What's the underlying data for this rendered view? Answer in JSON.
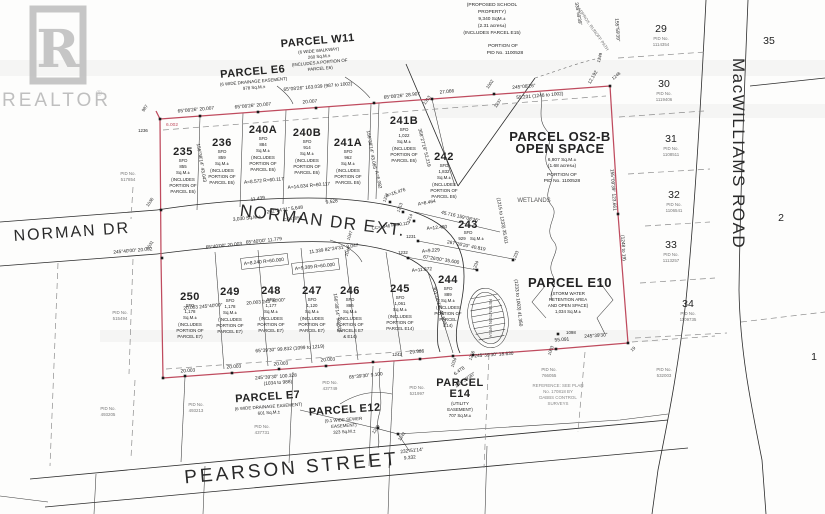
{
  "watermark": {
    "letter": "R",
    "brand": "REALTOR",
    "reg": "®"
  },
  "streets": {
    "norman_dr": "NORMAN DR",
    "norman_dr_ext": "NORMAN DR EXT.",
    "pearson": "PEARSON STREET",
    "macwilliams": "MacWILLIAMS ROAD",
    "nde_area": "3,030 Sq.M.±"
  },
  "school": {
    "l1": "(PROPOSED SCHOOL",
    "l2": "PROPERTY)",
    "l3": "9,340 SqM.±",
    "l4": "(2.31 acres±)",
    "l5": "(INCLUDES PARCEL E15)",
    "l6": "PORTION OF",
    "l7": "PID No. 1100528"
  },
  "parcels": {
    "e6": {
      "name": "PARCEL E6",
      "d1": "(6 WIDE DRAINAGE EASEMENT)",
      "d2": "978 Sq.M.±"
    },
    "w11": {
      "name": "PARCEL W11",
      "d1": "(6 WIDE WALKWAY)",
      "d2": "260 Sq.M.±",
      "d3": "(INCLUDES A PORTION OF",
      "d4": "PARCEL E6)"
    },
    "os2b": {
      "name": "PARCEL OS2-B",
      "name2": "OPEN SPACE",
      "d1": "6,807 Sq.M.±",
      "d2": "(1.68 acres±)",
      "d3": "PORTION OF",
      "d4": "PID No. 1100528"
    },
    "e10": {
      "name": "PARCEL E10",
      "d1": "(STORM WATER",
      "d2": "RETENTION AREA",
      "d3": "AND OPEN SPACE)",
      "d4": "1,034 Sq.M.±"
    },
    "e7": {
      "name": "PARCEL E7",
      "d1": "(6 WIDE DRAINAGE EASEMENT)",
      "d2": "601 Sq.M.±"
    },
    "e12": {
      "name": "PARCEL E12",
      "d1": "(9.1 WIDE SEWER",
      "d2": "EASEMENT)",
      "d3": "323 Sq.M.±"
    },
    "e14": {
      "name": "PARCEL",
      "name2": "E14",
      "d1": "(UTILITY",
      "d2": "EASEMENT)",
      "d3": "707 Sq.M.±"
    }
  },
  "lots": {
    "235": {
      "num": "235",
      "type": "SFD",
      "area": "855",
      "unit": "Sq.M.±",
      "n1": "(INCLUDES",
      "n2": "PORTION OF",
      "n3": "PARCEL E6)"
    },
    "236": {
      "num": "236",
      "type": "SFD",
      "area": "859",
      "unit": "Sq.M.±",
      "n1": "(INCLUDES",
      "n2": "PORTION OF",
      "n3": "PARCEL E6)"
    },
    "240A": {
      "num": "240A",
      "type": "SFD",
      "area": "884",
      "unit": "Sq.M.±",
      "n1": "(INCLUDES",
      "n2": "PORTION OF",
      "n3": "PARCEL E6)"
    },
    "240B": {
      "num": "240B",
      "type": "SFD",
      "area": "914",
      "unit": "Sq.M.±",
      "n1": "(INCLUDES",
      "n2": "PORTION OF",
      "n3": "PARCEL E6)"
    },
    "241A": {
      "num": "241A",
      "type": "SFD",
      "area": "962",
      "unit": "Sq.M.±",
      "n1": "(INCLUDES",
      "n2": "PORTION OF",
      "n3": "PARCEL E6)"
    },
    "241B": {
      "num": "241B",
      "type": "SFD",
      "area": "1,022",
      "unit": "Sq.M.±",
      "n1": "(INCLUDES",
      "n2": "PORTION OF",
      "n3": "PARCEL E6)"
    },
    "242": {
      "num": "242",
      "type": "SFD",
      "area": "1,832",
      "unit": "Sq.M.±",
      "n1": "(INCLUDES",
      "n2": "PORTION OF",
      "n3": "PARCEL E6)"
    },
    "243": {
      "num": "243",
      "type": "SFD",
      "area": "929",
      "unit": "Sq.M.±"
    },
    "244": {
      "num": "244",
      "type": "SFD",
      "area": "889",
      "unit": "Sq.M.±",
      "n1": "(INCLUDES",
      "n2": "PORTION OF",
      "n3": "PARCEL",
      "n4": "E14)"
    },
    "245": {
      "num": "245",
      "type": "SFD",
      "area": "1,061",
      "unit": "Sq.M.±",
      "n1": "(INCLUDES",
      "n2": "PORTION OF",
      "n3": "PARCEL E14)"
    },
    "246": {
      "num": "246",
      "type": "SFD",
      "area": "886",
      "unit": "Sq.M.±",
      "n1": "(INCLUDES",
      "n2": "PORTION OF",
      "n3": "PARCELS E7",
      "n4": "& E14)"
    },
    "247": {
      "num": "247",
      "type": "SFD",
      "area": "1,120",
      "unit": "Sq.M.±",
      "n1": "(INCLUDES",
      "n2": "PORTION OF",
      "n3": "PARCEL E7)"
    },
    "248": {
      "num": "248",
      "type": "SFD",
      "area": "1,177",
      "unit": "Sq.M.±",
      "n1": "(INCLUDES",
      "n2": "PORTION OF",
      "n3": "PARCEL E7)"
    },
    "249": {
      "num": "249",
      "type": "SFD",
      "area": "1,178",
      "unit": "Sq.M.±",
      "n1": "(INCLUDES",
      "n2": "PORTION OF",
      "n3": "PARCEL E7)"
    },
    "250": {
      "num": "250",
      "type": "SFD",
      "area": "1,178",
      "unit": "Sq.M.±",
      "n1": "(INCLUDES",
      "n2": "PORTION OF",
      "n3": "PARCEL E7)"
    }
  },
  "adj": {
    "29": {
      "num": "29",
      "pid": "PID No.",
      "pidno": "1114354"
    },
    "30": {
      "num": "30",
      "pid": "PID No.",
      "pidno": "1119406"
    },
    "31": {
      "num": "31",
      "pid": "PID No.",
      "pidno": "1108511"
    },
    "32": {
      "num": "32",
      "pid": "PID No.",
      "pidno": "1106541"
    },
    "33": {
      "num": "33",
      "pid": "PID No.",
      "pidno": "1113257"
    },
    "34": {
      "num": "34",
      "pid": "PID No.",
      "pidno": "1109735"
    },
    "35": {
      "num": "35"
    },
    "2": {
      "num": "2"
    },
    "1": {
      "num": "1"
    }
  },
  "pids": {
    "p517854": {
      "a": "PID No.",
      "b": "517854"
    },
    "p515494": {
      "a": "PID No.",
      "b": "515494"
    },
    "p493205": {
      "a": "PID No.",
      "b": "493205"
    },
    "p493213": {
      "a": "PID No.",
      "b": "493213"
    },
    "p437731": {
      "a": "PID No.",
      "b": "437731"
    },
    "p437749": {
      "a": "PID No.",
      "b": "437749"
    },
    "p521997": {
      "a": "PID No.",
      "b": "521997"
    },
    "p766055": {
      "a": "PID No.",
      "b": "766055"
    },
    "p532003": {
      "a": "PID No.",
      "b": "532003"
    }
  },
  "dims": [
    "65°08'26\"  20.007",
    "65°08'26\"  20.007",
    "65°08'26\"  163.039  (987 to 1002)",
    "20.007",
    "65°08'26\"  28.907",
    "27.066",
    "245°08'26\"",
    "55.231  (1248 to 1002)",
    "12.192",
    "6.002",
    "20.003  245°40'00\"",
    "20.003  245°40'00\"",
    "11.439",
    "262°24'31\"  5.648",
    "9.528",
    "65°40'00\"  20.003",
    "65°40'00\"  11.779",
    "A=8.240  R=60.000",
    "A=9.389  R=60.000",
    "11.339  82°24'31\"  8.047",
    "A=15.476",
    "A=6.082",
    "A=8.464",
    "45.716  159°08'26\"",
    "267°26'20\"  40.819",
    "67°26'00\"  35.600",
    "A=12.480",
    "A=9.229",
    "A=11.872",
    "358°27'19\"  52.219",
    "156°38'14\"  43.043",
    "156°38'14\"  43.065",
    "156°38'14\"  58.328",
    "301°06'19\"  48.609",
    "(1215 to 1233)  35.911",
    "(1233 to 1003)  41.350",
    "155°09'39\"  123.661",
    "(1248 to 19)",
    "155°59'39\"",
    "335°59'39\"",
    "245°40'00\"  20.002",
    "20.003",
    "20.003",
    "20.003",
    "20.003",
    "245°39'30\"  100.328",
    "(1034 to 988)",
    "65°39'30\"  99.832  (1099 to 1219)",
    "29.986",
    "245°39'30\"  18.630",
    "55.091",
    "245°39'30\"",
    "6.478",
    "245°39'30\"",
    "232°51'14\"",
    "9.332",
    "65°39'30\"  9.100",
    "A=8.572  R=60.117",
    "A=14.834  R=60.117"
  ],
  "markers": [
    "987",
    "1236",
    "1036",
    "1031",
    "1002",
    "1313",
    "1237",
    "1248",
    "1249",
    "1211",
    "1213",
    "1214",
    "1231",
    "1232",
    "1233",
    "1234",
    "1046",
    "1047",
    "1034",
    "1216",
    "1003",
    "1098",
    "19",
    "1242",
    "1239",
    "1241"
  ],
  "misc": {
    "wetlands": "WETLANDS",
    "retention": "RETENTION AREA",
    "cc1": "CC=1050",
    "cc2": "CC=1046  R=20.117",
    "runoff": "APPROX. RUNOFF PATH",
    "ref1": "REFERENCE:  SEE  PLAN",
    "ref2": "No. 170818 BY",
    "ref3": "DABBS CONTROL",
    "ref4": "SURVEYS"
  },
  "colors": {
    "boundary": "#bf4b5e",
    "ink": "#232323",
    "dash": "#8d8d8d",
    "watermark": "#bdbdbd"
  }
}
